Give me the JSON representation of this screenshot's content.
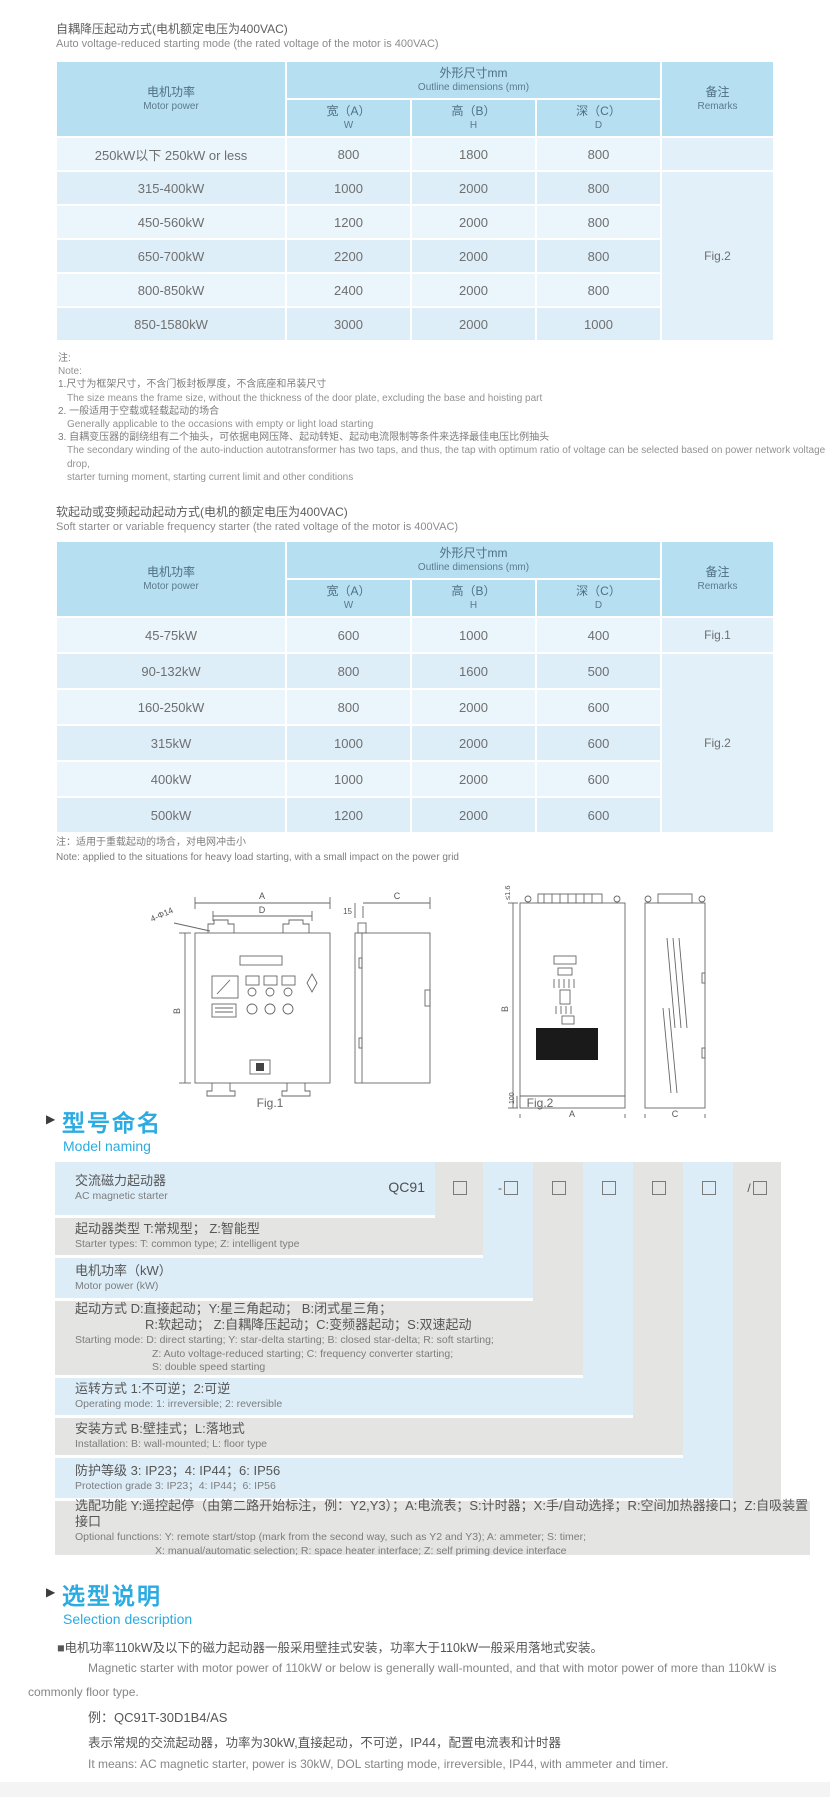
{
  "section1": {
    "title_cn": "自耦降压起动方式(电机额定电压为400VAC)",
    "title_en": "Auto voltage-reduced starting mode (the rated voltage of the motor is 400VAC)",
    "header": {
      "motor_cn": "电机功率",
      "motor_en": "Motor power",
      "dims_cn": "外形尺寸mm",
      "dims_en": "Outline dimensions (mm)",
      "w_cn": "宽（A）",
      "w_en": "W",
      "h_cn": "高（B）",
      "h_en": "H",
      "d_cn": "深（C）",
      "d_en": "D",
      "remarks_cn": "备注",
      "remarks_en": "Remarks"
    },
    "rows": [
      {
        "power": "250kW以下 250kW or less",
        "w": "800",
        "h": "1800",
        "d": "800"
      },
      {
        "power": "315-400kW",
        "w": "1000",
        "h": "2000",
        "d": "800"
      },
      {
        "power": "450-560kW",
        "w": "1200",
        "h": "2000",
        "d": "800"
      },
      {
        "power": "650-700kW",
        "w": "2200",
        "h": "2000",
        "d": "800"
      },
      {
        "power": "800-850kW",
        "w": "2400",
        "h": "2000",
        "d": "800"
      },
      {
        "power": "850-1580kW",
        "w": "3000",
        "h": "2000",
        "d": "1000"
      }
    ],
    "remark_fig": "Fig.2",
    "notes": [
      "注:",
      "Note:",
      "1.尺寸为框架尺寸，不含门板封板厚度，不含底座和吊装尺寸",
      "The size means the frame size, without the thickness of the door plate, excluding the base and hoisting part",
      "2. 一般适用于空载或轻载起动的场合",
      "Generally applicable to the occasions with empty or light load starting",
      "3. 自耦变压器的副绕组有二个抽头，可依据电网压降、起动转矩、起动电流限制等条件来选择最佳电压比例抽头",
      "The secondary winding of the auto-induction autotransformer has two taps, and thus, the tap with optimum ratio of voltage can be selected based on power network voltage drop,",
      "starter turning moment, starting current limit and other conditions"
    ]
  },
  "section2": {
    "title_cn": "软起动或变频起动起动方式(电机的额定电压为400VAC)",
    "title_en": "Soft starter or variable frequency starter (the rated voltage of the motor is 400VAC)",
    "header": {
      "motor_cn": "电机功率",
      "motor_en": "Motor power",
      "dims_cn": "外形尺寸mm",
      "dims_en": "Outline dimensions (mm)",
      "w_cn": "宽（A）",
      "w_en": "W",
      "h_cn": "高（B）",
      "h_en": "H",
      "d_cn": "深（C）",
      "d_en": "D",
      "remarks_cn": "备注",
      "remarks_en": "Remarks"
    },
    "rows": [
      {
        "power": "45-75kW",
        "w": "600",
        "h": "1000",
        "d": "400"
      },
      {
        "power": "90-132kW",
        "w": "800",
        "h": "1600",
        "d": "500"
      },
      {
        "power": "160-250kW",
        "w": "800",
        "h": "2000",
        "d": "600"
      },
      {
        "power": "315kW",
        "w": "1000",
        "h": "2000",
        "d": "600"
      },
      {
        "power": "400kW",
        "w": "1000",
        "h": "2000",
        "d": "600"
      },
      {
        "power": "500kW",
        "w": "1200",
        "h": "2000",
        "d": "600"
      }
    ],
    "remark_fig1": "Fig.1",
    "remark_fig2": "Fig.2",
    "note_cn": "注：适用于重载起动的场合，对电网冲击小",
    "note_en": "Note: applied to the situations for heavy load starting, with a small impact on the power grid"
  },
  "figures": {
    "fig1_caption": "Fig.1",
    "fig2_caption": "Fig.2",
    "labels": {
      "a": "A",
      "d": "D",
      "holes": "4-Φ14",
      "b": "B",
      "fifteen": "15",
      "c": "C",
      "le": "≤1.6",
      "hundred": "100",
      "a2": "A",
      "b2": "B",
      "c2": "C"
    }
  },
  "model_naming": {
    "heading_cn": "型号命名",
    "heading_en": "Model naming",
    "prefix": "QC91",
    "boxes": [
      "",
      "-",
      "",
      "",
      "",
      "",
      "/"
    ],
    "rows": [
      {
        "cn": "交流磁力起动器",
        "en": "AC magnetic starter"
      },
      {
        "cn": "起动器类型 T:常规型； Z:智能型",
        "en": "Starter types: T: common type; Z: intelligent type"
      },
      {
        "cn": "电机功率（kW）",
        "en": "Motor power (kW)"
      },
      {
        "cn1": "起动方式 D:直接起动；Y:星三角起动；  B:闭式星三角；",
        "cn2": "R:软起动；  Z:自耦降压起动；C:变频器起动；S:双速起动",
        "en1": "Starting mode: D: direct starting; Y: star-delta starting; B: closed star-delta; R: soft starting;",
        "en2": "Z: Auto voltage-reduced starting; C: frequency converter starting;",
        "en3": "S: double speed starting"
      },
      {
        "cn": "运转方式 1:不可逆；2:可逆",
        "en": "Operating mode: 1: irreversible; 2: reversible"
      },
      {
        "cn": "安装方式 B:壁挂式；L:落地式",
        "en": "Installation: B: wall-mounted; L: floor type"
      },
      {
        "cn": "防护等级 3: IP23；4: IP44；6: IP56",
        "en": "Protection grade 3: IP23；4: IP44；6: IP56"
      },
      {
        "cn": "选配功能 Y:遥控起停（由第二路开始标注，例：Y2,Y3）；A:电流表；S:计时器；X:手/自动选择；R:空间加热器接口；Z:自吸装置接口",
        "en1": "Optional functions: Y: remote start/stop (mark from the second way, such as Y2 and Y3); A: ammeter; S: timer;",
        "en2": "X: manual/automatic selection; R: space heater interface; Z: self priming device interface"
      }
    ]
  },
  "selection": {
    "heading_cn": "选型说明",
    "heading_en": "Selection description",
    "p1_cn": "■电机功率110kW及以下的磁力起动器一般采用壁挂式安装，功率大于110kW一般采用落地式安装。",
    "p1_en1": "Magnetic starter with motor power of 110kW or below is generally wall-mounted, and that with motor power of more than 110kW is",
    "p1_en2": "commonly floor type.",
    "example": "例：QC91T-30D1B4/AS",
    "p2_cn": "表示常规的交流起动器，功率为30kW,直接起动，不可逆，IP44，配置电流表和计时器",
    "p2_en": "It means: AC magnetic starter, power is 30kW, DOL starting mode, irreversible, IP44, with ammeter and timer."
  },
  "colors": {
    "accent": "#2aabe2",
    "table_header": "#b6dff2",
    "row_light": "#eaf5fc",
    "row_dark": "#ddeef8",
    "strip_gray": "#e4e4e2",
    "strip_blue": "#dcedf8"
  }
}
